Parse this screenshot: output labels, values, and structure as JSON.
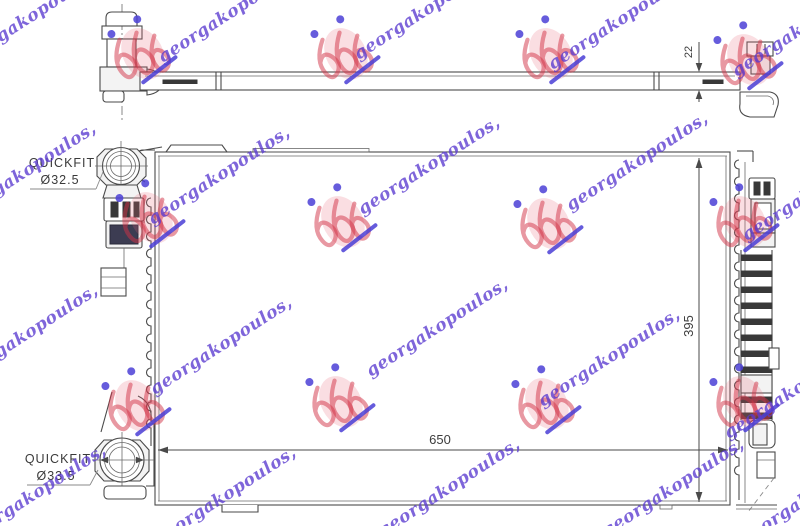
{
  "watermark": {
    "script_text": "georgakopoulos,",
    "script_color": "#5a3bd0",
    "stamp_color": "#d23246",
    "dot_color": "#4b3fd6",
    "center_line1": "POLOVNI",
    "center_line2": "AUTOMOBILI",
    "center_color": "#dcdcdc"
  },
  "drawing": {
    "labels": {
      "quickfit_top": {
        "line1": "QUICKFIT",
        "line2": "Ø32.5"
      },
      "quickfit_bottom": {
        "line1": "QUICKFIT",
        "line2": "Ø33.5"
      }
    },
    "dims": {
      "width": "650",
      "height": "395",
      "depth": "22"
    }
  }
}
